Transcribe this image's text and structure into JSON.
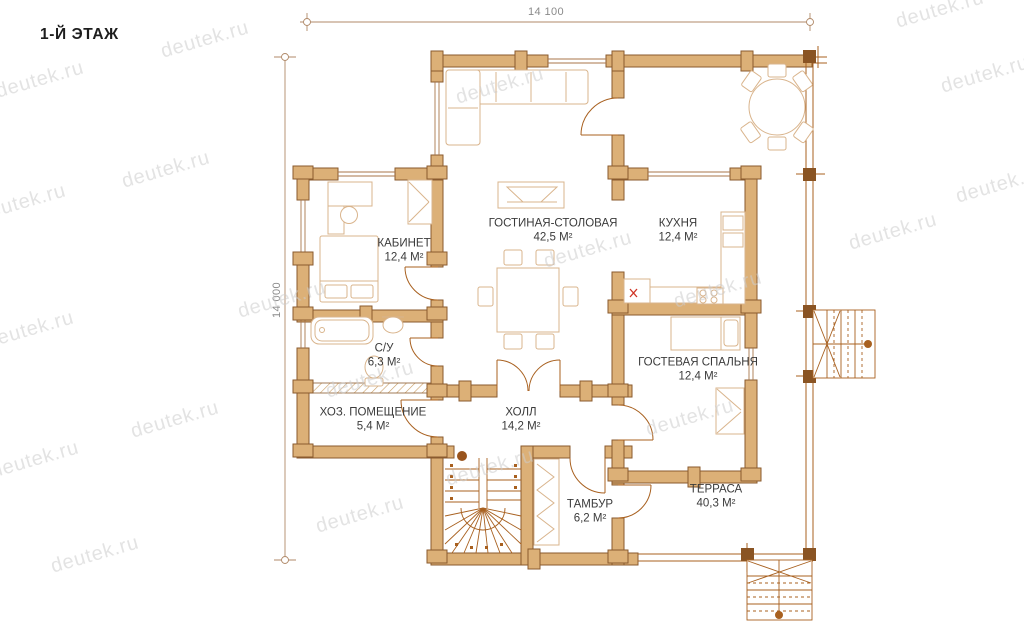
{
  "page": {
    "title": "1-Й ЭТАЖ",
    "watermark": "deutek.ru"
  },
  "dimensions": {
    "width": "14 100",
    "height": "14 000"
  },
  "rooms": [
    {
      "name": "ГОСТИНАЯ-СТОЛОВАЯ",
      "area": "42,5 М²"
    },
    {
      "name": "КУХНЯ",
      "area": "12,4 М²"
    },
    {
      "name": "КАБИНЕТ",
      "area": "12,4 М²"
    },
    {
      "name": "С/У",
      "area": "6,3 М²"
    },
    {
      "name": "ХОЗ. ПОМЕЩЕНИЕ",
      "area": "5,4 М²"
    },
    {
      "name": "ХОЛЛ",
      "area": "14,2 М²"
    },
    {
      "name": "ГОСТЕВАЯ СПАЛЬНЯ",
      "area": "12,4 М²"
    },
    {
      "name": "ТАМБУР",
      "area": "6,2 М²"
    },
    {
      "name": "ТЕРРАСА",
      "area": "40,3 М²"
    }
  ],
  "colors": {
    "wall_fill": "#dcb077",
    "wall_stroke": "#8a5a2e",
    "detail": "#a8601f",
    "furniture": "#d9b48c",
    "dark_joint": "#8a5423",
    "label_text": "#3b3b3b",
    "watermark": "#cdcdcd",
    "accent_red": "#cf3526",
    "dimension": "#b08968"
  }
}
